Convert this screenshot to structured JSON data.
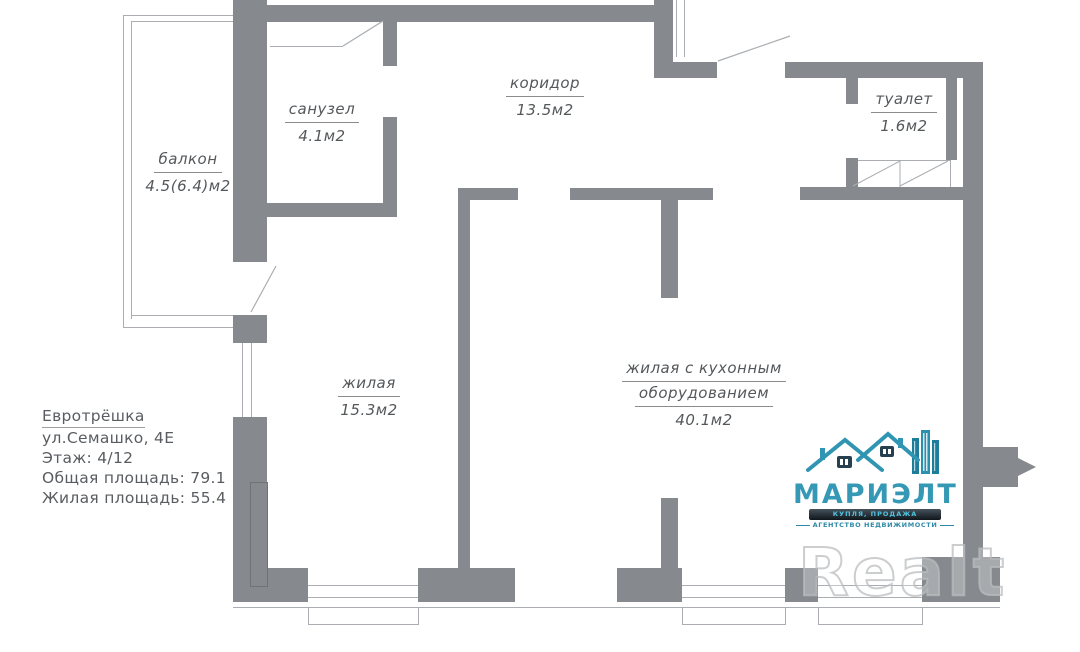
{
  "plan": {
    "rooms": [
      {
        "name": "балкон",
        "area": "4.5(6.4)м2"
      },
      {
        "name": "санузел",
        "area": "4.1м2"
      },
      {
        "name": "коридор",
        "area": "13.5м2"
      },
      {
        "name": "туалет",
        "area": "1.6м2"
      },
      {
        "name": "жилая",
        "area": "15.3м2"
      },
      {
        "name": "жилая с кухонным",
        "name2": "оборудованием",
        "area": "40.1м2"
      }
    ],
    "info": {
      "title": "Евротрёшка",
      "address": "ул.Семашко, 4Е",
      "floor": "Этаж: 4/12",
      "total_area": "Общая площадь: 79.1",
      "living_area": "Жилая площадь: 55.4"
    }
  },
  "logo": {
    "name": "МАРИЭЛТ",
    "banner": "КУПЛЯ, ПРОДАЖА",
    "tagline": "АГЕНТСТВО НЕДВИЖИМОСТИ"
  },
  "watermark": "Realt",
  "colors": {
    "wall": "#868a8e",
    "thin_line": "#aaaeb2",
    "label_text": "#54585b",
    "logo_teal": "#3598b5",
    "banner_dark": "#10161b"
  }
}
